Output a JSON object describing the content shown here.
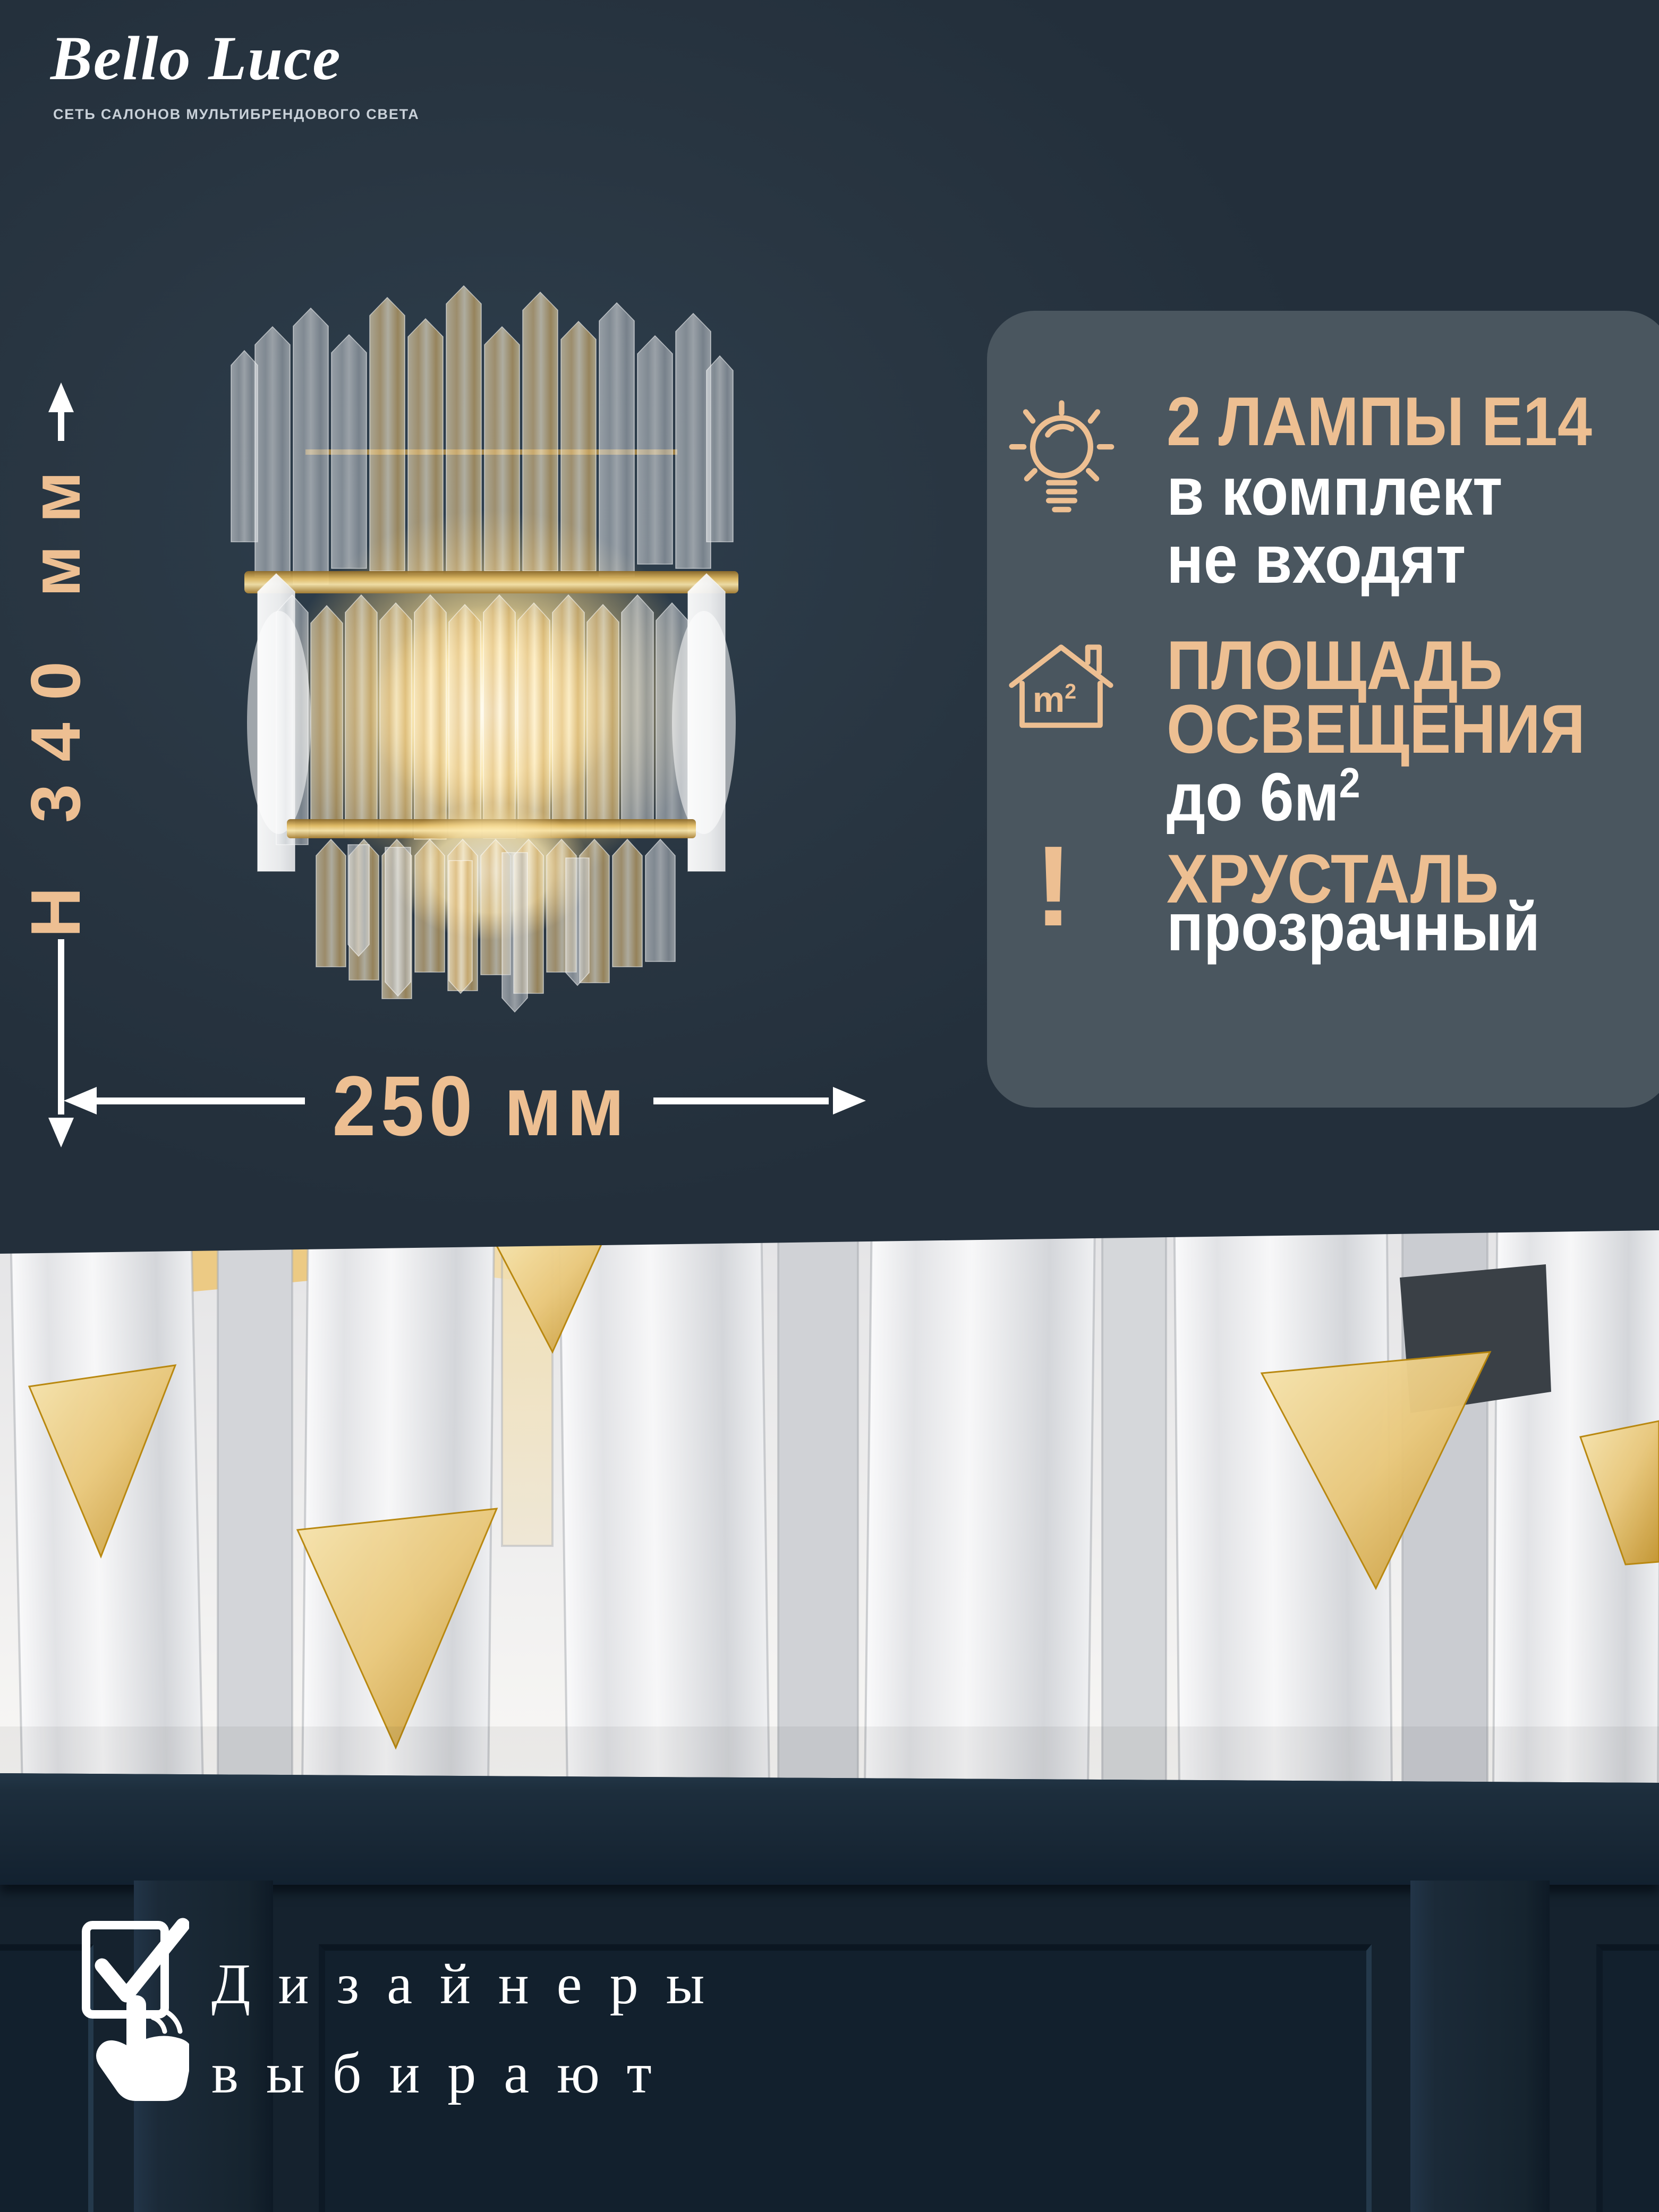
{
  "colors": {
    "accent": "#edbf92",
    "panel": "#4a565f",
    "hero": "#293642",
    "wall": "#15222e",
    "gold": "#d9ad5c"
  },
  "brand": {
    "name": "Bello Luce",
    "tagline": "СЕТЬ САЛОНОВ МУЛЬТИБРЕНДОВОГО СВЕТА"
  },
  "dimensions": {
    "height": "H 340 мм",
    "width": "250 мм"
  },
  "specs": {
    "lamps": {
      "icon": "light-bulb-icon",
      "title": "2 ЛАМПЫ E14",
      "line1": "в комплект",
      "line2": "не входят"
    },
    "area": {
      "icon": "house-m2-icon",
      "icon_label_base": "m",
      "icon_label_sup": "2",
      "title1": "ПЛОЩАДЬ",
      "title2": "ОСВЕЩЕНИЯ",
      "value_base": "до 6м",
      "value_sup": "2"
    },
    "crystal": {
      "icon": "exclamation-icon",
      "icon_glyph": "!",
      "title": "ХРУСТАЛЬ",
      "value": "прозрачный"
    }
  },
  "footer": {
    "icon": "checkbox-hand-icon",
    "line1": "Дизайнеры",
    "line2": "выбирают"
  }
}
